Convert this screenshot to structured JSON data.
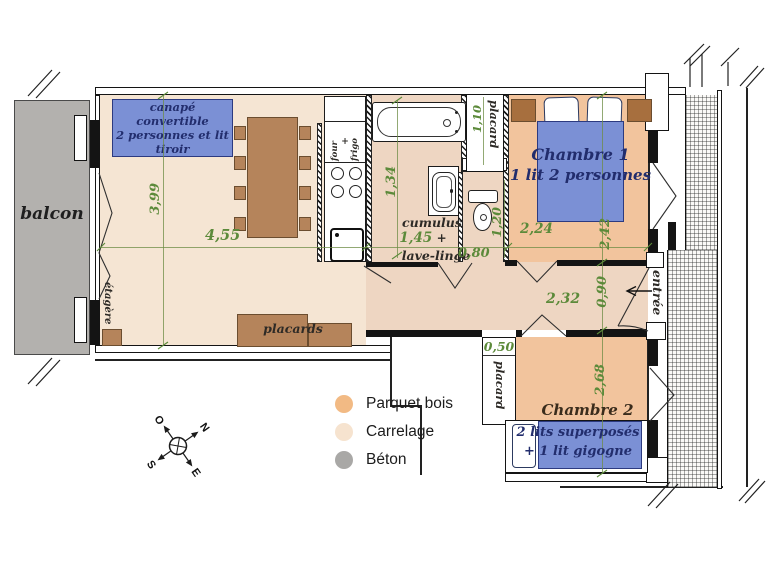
{
  "plan": {
    "balcony": {
      "label": "balcon"
    },
    "living_room": {
      "sofa_label_line1": "canapé convertible",
      "sofa_label_line2": "2 personnes et lit tiroir",
      "closets_label": "placards",
      "shelf_label": "étagère",
      "width_dim": "4,55",
      "depth_dim": "3,99"
    },
    "kitchen": {
      "oven_label": "four",
      "plus_sign": "+",
      "fridge_label": "frigo"
    },
    "bathroom": {
      "heater_label": "cumulus",
      "width_dim": "1,45",
      "plus_sign": "+",
      "washer_label": "lave-linge",
      "depth_dim": "1,34",
      "door_dim": "0,80",
      "wc_dim": "1,20"
    },
    "closet_bath": {
      "label": "placard",
      "dim": "1,10"
    },
    "bedroom1": {
      "title": "Chambre 1",
      "subtitle": "1 lit 2 personnes",
      "width_dim": "2,24",
      "depth_dim": "2,42"
    },
    "hallway": {
      "width_dim": "2,32",
      "entry_dim": "0,90",
      "entrance_label": "entrée"
    },
    "bedroom2": {
      "title": "Chambre 2",
      "bed_label_line1": "2 lits superposés",
      "bed_label_line2": "+ 1 lit gigogne",
      "depth_dim": "2,68",
      "closet_label": "placard",
      "closet_dim": "0,50"
    }
  },
  "legend": {
    "items": [
      {
        "label": "Parquet bois",
        "color": "#f2ba84"
      },
      {
        "label": "Carrelage",
        "color": "#f6e3cf"
      },
      {
        "label": "Béton",
        "color": "#a9a8a6"
      }
    ]
  },
  "compass": {
    "north": "N",
    "south": "S",
    "east": "E",
    "west": "O"
  },
  "colors": {
    "parquet": "#f2c49d",
    "carrelage": "#f5e5d3",
    "tile": "#eed6c2",
    "concrete": "#b3b1ae",
    "bed_blue": "#7b90d5",
    "label_navy": "#222d6d",
    "dim_green": "#5c8a3a",
    "wood": "#b5845b"
  }
}
